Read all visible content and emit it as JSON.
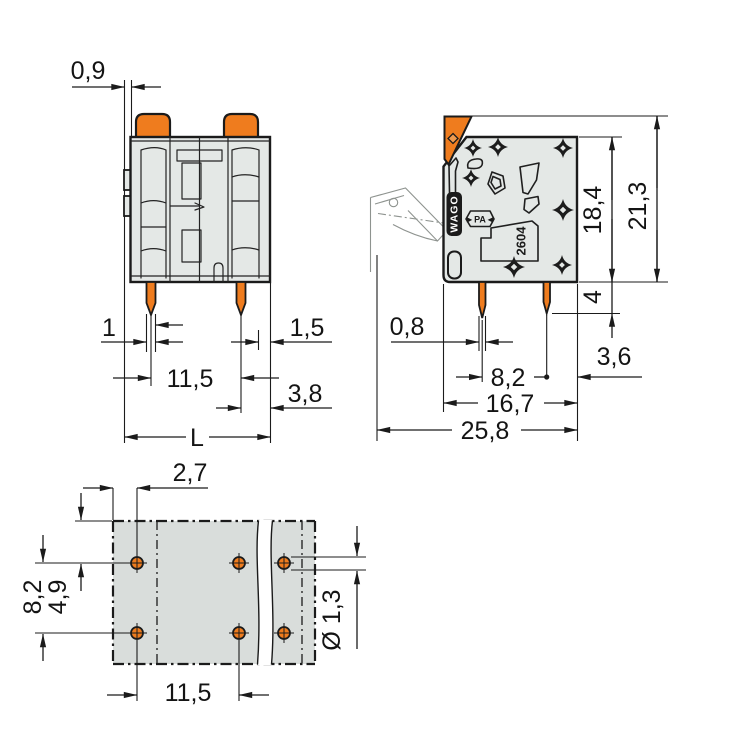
{
  "drawing_type": "terminal-block-dimensional-drawing",
  "views": {
    "front": {
      "dims": {
        "tab_offset": "0,9",
        "pin_width": "1",
        "edge_wall": "1,5",
        "pin_pitch": "11,5",
        "pin_to_edge": "3,8",
        "length": "L"
      }
    },
    "side": {
      "markings": {
        "brand": "WAGO",
        "material": "►PA◄",
        "series": "2604"
      },
      "dims": {
        "housing_height": "18,4",
        "total_height": "21,3",
        "pin_length": "4",
        "pin_thickness": "0,8",
        "pin_row_pitch": "8,2",
        "pin_to_back": "3,6",
        "housing_depth": "16,7",
        "total_depth": "25,8"
      }
    },
    "footprint": {
      "dims": {
        "edge_to_hole": "2,7",
        "row_pitch": "8,2",
        "edge_to_row": "4,9",
        "hole_pitch": "11,5",
        "hole_diameter": "Ø 1,3"
      }
    }
  },
  "colors": {
    "accent_orange": "#EF7C1E",
    "housing_gray": "#E4E8E6",
    "footprint_gray": "#D9DDDB",
    "line_dark": "#1B1B1B",
    "ghost_gray": "#8E938F"
  }
}
